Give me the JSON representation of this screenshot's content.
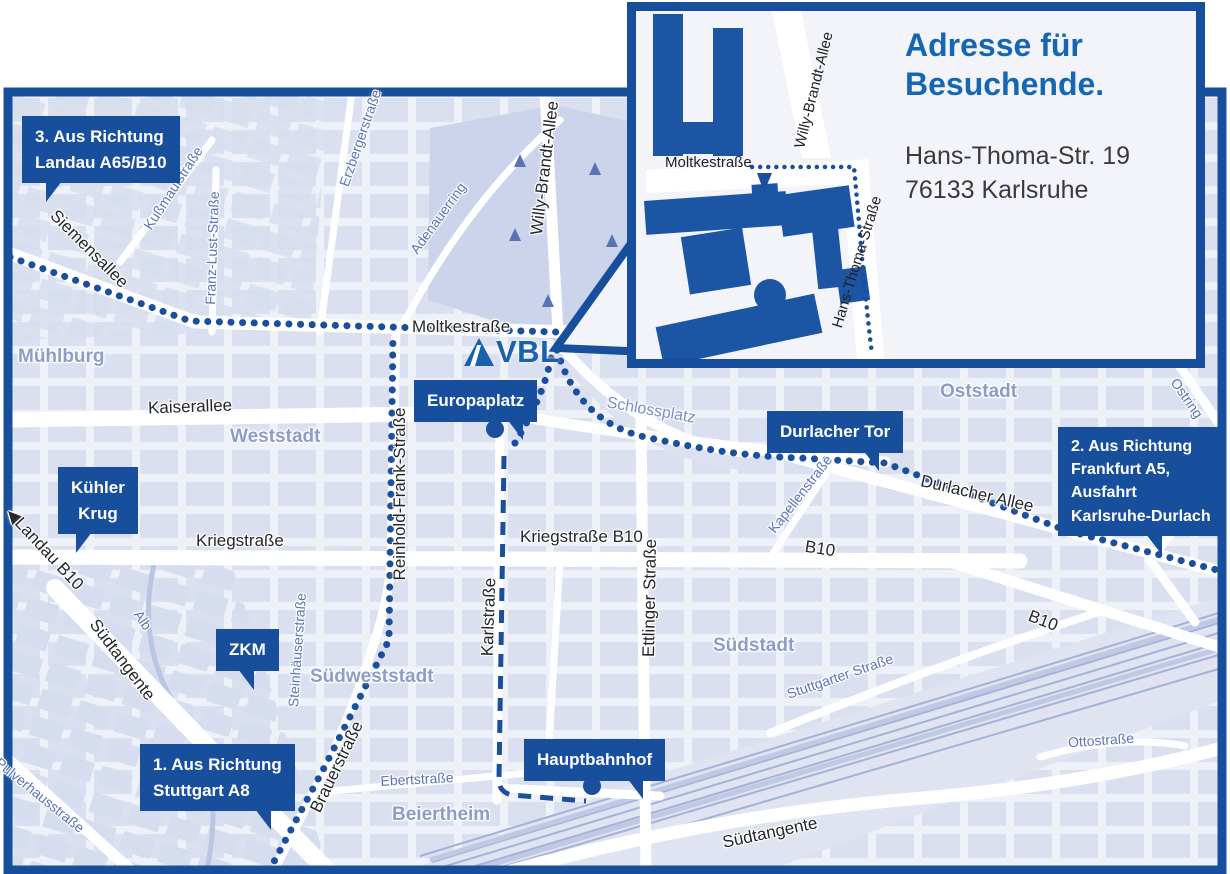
{
  "colors": {
    "brand_blue": "#174f9c",
    "logo_blue": "#1961ad",
    "title_blue": "#1766b3",
    "map_background": "#eef1f8",
    "block_fill": "#d9dfef",
    "park_fill": "#cbd4ea",
    "street_label_dark": "#26272b",
    "street_label_blue": "#5b74b7",
    "district_label": "#8d9cc9",
    "road_white": "#ffffff"
  },
  "inset": {
    "title": "Adresse für Besuchende.",
    "address": {
      "line1": "Hans-Thoma-Str. 19",
      "line2": "76133 Karlsruhe"
    },
    "streets": {
      "moltkestrasse": "Moltkestraße",
      "willy_brandt_allee": "Willy-Brandt-Allee",
      "hans_thoma_strasse": "Hans-Thoma-Straße"
    }
  },
  "logo": {
    "text": "VBL"
  },
  "callouts": {
    "route3": {
      "lines": [
        "3. Aus Richtung",
        "Landau A65/B10"
      ]
    },
    "route2": {
      "lines": [
        "2. Aus Richtung",
        "Frankfurt A5,",
        "Ausfahrt",
        "Karlsruhe-Durlach"
      ]
    },
    "route1": {
      "lines": [
        "1. Aus Richtung",
        "Stuttgart A8"
      ]
    },
    "kuehler_krug": {
      "lines": [
        "Kühler",
        "Krug"
      ]
    },
    "zkm": {
      "lines": [
        "ZKM"
      ]
    },
    "europaplatz": {
      "lines": [
        "Europaplatz"
      ]
    },
    "durlacher_tor": {
      "lines": [
        "Durlacher Tor"
      ]
    },
    "hauptbahnhof": {
      "lines": [
        "Hauptbahnhof"
      ]
    }
  },
  "streets": {
    "siemensallee": "Siemensallee",
    "kussmaulstrasse": "Kußmaulstraße",
    "franz_lust_strasse": "Franz-Lust-Straße",
    "erzbergerstrasse": "Erzbergerstraße",
    "adenauerring": "Adenauerring",
    "willy_brandt_allee": "Willy-Brandt-Allee",
    "moltkestrasse": "Moltkestraße",
    "kaiserallee": "Kaiserallee",
    "landau_b10": "Landau B10",
    "kriegstrasse": "Kriegstraße",
    "kriegstrasse_b10": "Kriegstraße B10",
    "reinhold_frank_strasse": "Reinhold-Frank-Straße",
    "karlstrasse": "Karlstraße",
    "ettlinger_strasse": "Ettlinger Straße",
    "schlossplatz": "Schlossplatz",
    "kapellenstrasse": "Kapellenstraße",
    "durlacher_allee": "Durlacher Allee",
    "b10_mid": "B10",
    "b10_southeast": "B10",
    "ostring_upper": "Ostring",
    "ostring_lower": "Ostring",
    "steinhaeuserstrasse": "Steinhäuserstraße",
    "brauerstrasse": "Brauerstraße",
    "ebertstrasse": "Ebertstraße",
    "suedtangente_west": "Südtangente",
    "suedtangente_southeast": "Südtangente",
    "stuttgarter_strasse": "Stuttgarter Straße",
    "ottostrasse": "Ottostraße",
    "alb": "Alb",
    "pulverhausstrasse": "Pulverhausstraße"
  },
  "districts": {
    "muehlburg": "Mühlburg",
    "weststadt": "Weststadt",
    "oststadt": "Oststadt",
    "suedstadt": "Südstadt",
    "suedweststadt": "Südweststadt",
    "beiertheim": "Beiertheim"
  }
}
